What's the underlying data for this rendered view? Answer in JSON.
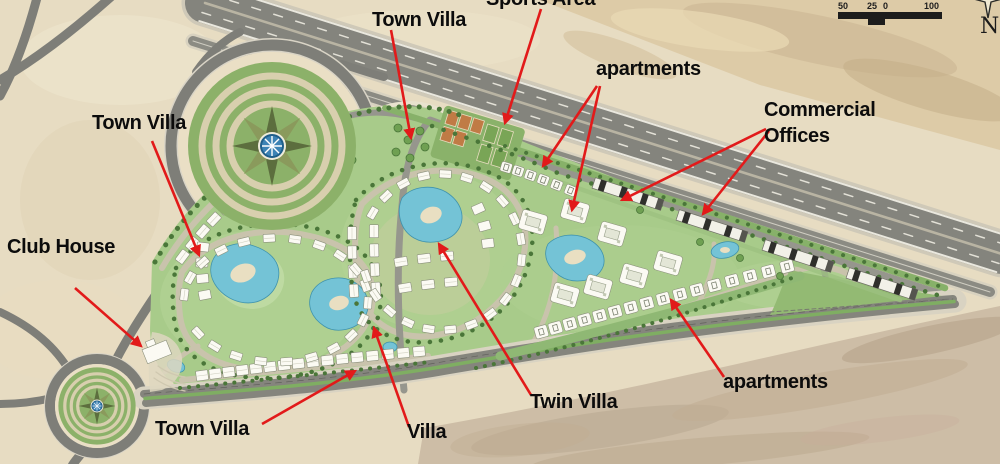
{
  "page": {
    "type": "master-plan-aerial-map",
    "description": "Aerial master plan of a triangular residential development beside a highway"
  },
  "annotations": {
    "labels": [
      {
        "id": "sports-area",
        "text": "Sports Area",
        "x": 486,
        "y": -14,
        "arrows": [
          [
            541,
            9,
            505,
            123
          ]
        ]
      },
      {
        "id": "town-villa-top",
        "text": "Town Villa",
        "x": 372,
        "y": 7,
        "arrows": [
          [
            391,
            30,
            411,
            138
          ]
        ]
      },
      {
        "id": "apartments-top",
        "text": "apartments",
        "x": 596,
        "y": 56,
        "arrows": [
          [
            597,
            86,
            543,
            166
          ],
          [
            600,
            86,
            572,
            210
          ]
        ]
      },
      {
        "id": "commercial-offices",
        "text": "Commercial\nOffices",
        "x": 764,
        "y": 97,
        "arrows": [
          [
            766,
            129,
            622,
            200
          ],
          [
            769,
            131,
            703,
            214
          ]
        ]
      },
      {
        "id": "town-villa-left",
        "text": "Town Villa",
        "x": 92,
        "y": 110,
        "arrows": [
          [
            152,
            141,
            199,
            255
          ]
        ]
      },
      {
        "id": "club-house",
        "text": "Club House",
        "x": 7,
        "y": 234,
        "arrows": [
          [
            75,
            288,
            141,
            346
          ]
        ]
      },
      {
        "id": "town-villa-bottom",
        "text": "Town Villa",
        "x": 155,
        "y": 416,
        "arrows": [
          [
            262,
            424,
            355,
            371
          ]
        ]
      },
      {
        "id": "villa",
        "text": "Villa",
        "x": 407,
        "y": 419,
        "arrows": [
          [
            409,
            427,
            374,
            328
          ]
        ]
      },
      {
        "id": "twin-villa",
        "text": "Twin Villa",
        "x": 530,
        "y": 389,
        "arrows": [
          [
            531,
            395,
            439,
            244
          ]
        ]
      },
      {
        "id": "apartments-bottom",
        "text": "apartments",
        "x": 723,
        "y": 369,
        "arrows": [
          [
            724,
            377,
            671,
            300
          ]
        ]
      }
    ]
  },
  "scale_bar": {
    "ticks": [
      {
        "label": "50",
        "x": 2
      },
      {
        "label": "25",
        "x": 31
      },
      {
        "label": "0",
        "x": 47
      },
      {
        "label": "100",
        "x": 88
      }
    ]
  },
  "compass": {
    "label": "N"
  },
  "colors": {
    "desert": "#e7dcc2",
    "asphalt": "#84847d",
    "site_green": "#a8cb8a",
    "water": "#74c3d6",
    "annotation_red": "#e21a1a",
    "label_text": "#0c0c0c"
  }
}
